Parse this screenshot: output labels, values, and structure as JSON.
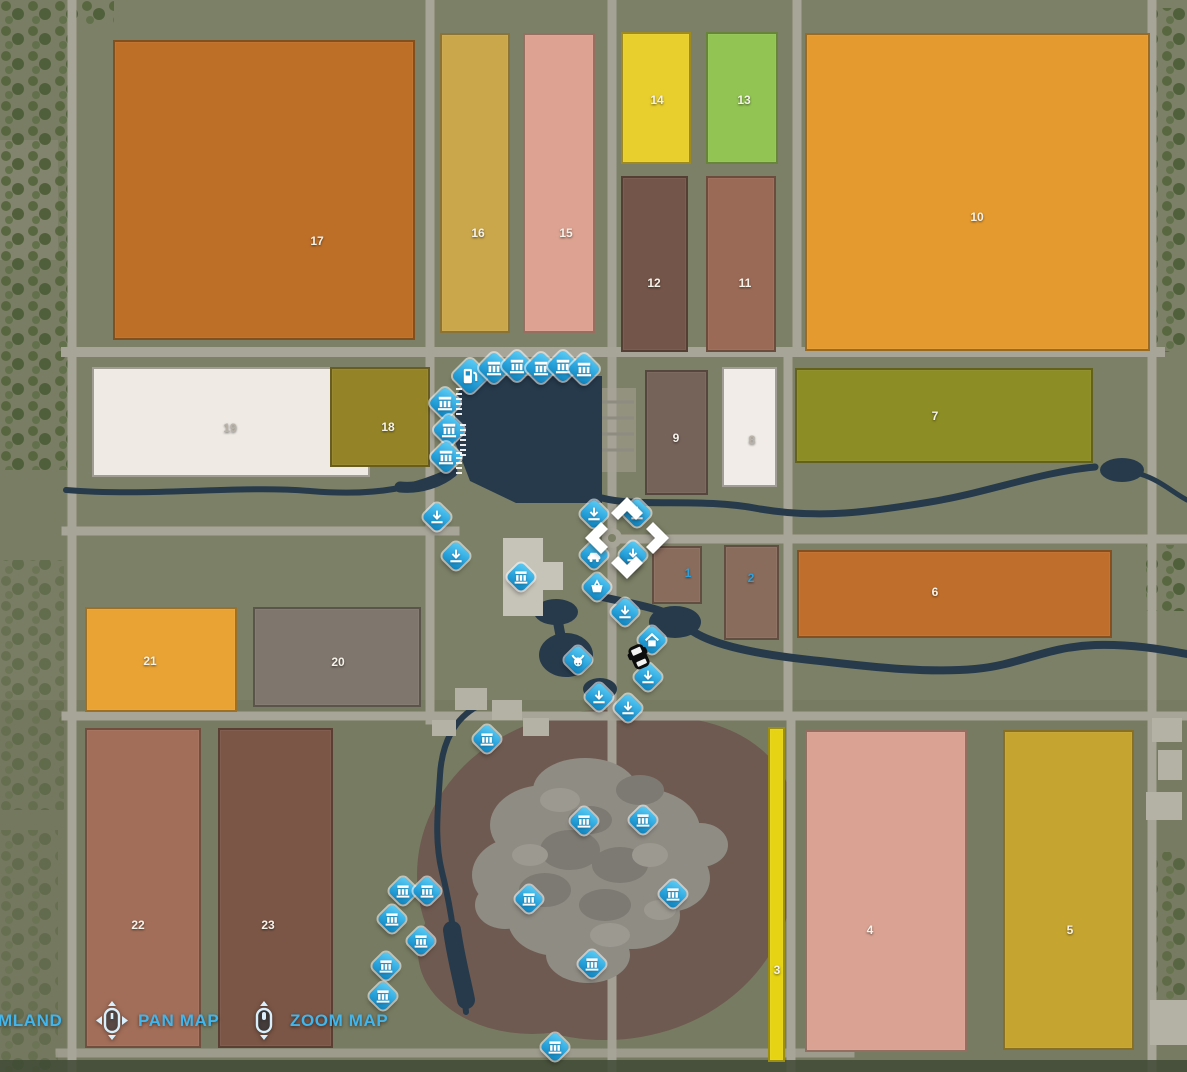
{
  "map": {
    "background_color": "#7c8066",
    "road_color": "#a7a498",
    "water_color": "#263a4c",
    "quarry_color": "#6e5a50",
    "rock_color": "#8f8c84",
    "tree_color": "#57663f",
    "marker_blue": "#2aa4dd",
    "field_number_color": "#f5f2ea",
    "owned_field_number_color": "#2d9fdb",
    "accent_color": "#41b5ec"
  },
  "fields": [
    {
      "number": "17",
      "x": 113,
      "y": 40,
      "w": 302,
      "h": 300,
      "color": "#bd6f28",
      "label_x": 317,
      "label_y": 241
    },
    {
      "number": "16",
      "x": 440,
      "y": 33,
      "w": 70,
      "h": 300,
      "color": "#cba74b",
      "label_x": 478,
      "label_y": 233
    },
    {
      "number": "15",
      "x": 523,
      "y": 33,
      "w": 72,
      "h": 300,
      "color": "#dda291",
      "label_x": 566,
      "label_y": 233
    },
    {
      "number": "14",
      "x": 621,
      "y": 32,
      "w": 70,
      "h": 132,
      "color": "#e9cf2d",
      "label_x": 657,
      "label_y": 100
    },
    {
      "number": "13",
      "x": 706,
      "y": 32,
      "w": 72,
      "h": 132,
      "color": "#92c453",
      "label_x": 744,
      "label_y": 100
    },
    {
      "number": "12",
      "x": 621,
      "y": 176,
      "w": 67,
      "h": 176,
      "color": "#745549",
      "label_x": 654,
      "label_y": 283
    },
    {
      "number": "11",
      "x": 706,
      "y": 176,
      "w": 70,
      "h": 176,
      "color": "#9a6a56",
      "label_x": 745,
      "label_y": 283
    },
    {
      "number": "10",
      "x": 805,
      "y": 33,
      "w": 345,
      "h": 318,
      "color": "#e49a2e",
      "label_x": 977,
      "label_y": 217
    },
    {
      "number": "19",
      "x": 92,
      "y": 367,
      "w": 278,
      "h": 110,
      "color": "#efeae4",
      "label_x": 230,
      "label_y": 428,
      "number_color": "#b9b3a9"
    },
    {
      "number": "18",
      "x": 330,
      "y": 367,
      "w": 100,
      "h": 100,
      "color": "#948427",
      "label_x": 388,
      "label_y": 427
    },
    {
      "number": "9",
      "x": 645,
      "y": 370,
      "w": 63,
      "h": 125,
      "color": "#756259",
      "label_x": 676,
      "label_y": 438
    },
    {
      "number": "8",
      "x": 722,
      "y": 367,
      "w": 55,
      "h": 120,
      "color": "#f1ece7",
      "label_x": 752,
      "label_y": 440,
      "number_color": "#b9b3a9"
    },
    {
      "number": "7",
      "x": 795,
      "y": 368,
      "w": 298,
      "h": 95,
      "color": "#8c8d24",
      "label_x": 935,
      "label_y": 416
    },
    {
      "number": "1",
      "x": 652,
      "y": 546,
      "w": 50,
      "h": 58,
      "color": "#8a6c5c",
      "label_x": 688,
      "label_y": 573,
      "owned": true
    },
    {
      "number": "2",
      "x": 724,
      "y": 545,
      "w": 55,
      "h": 95,
      "color": "#8a6c5c",
      "label_x": 751,
      "label_y": 578,
      "owned": true
    },
    {
      "number": "6",
      "x": 797,
      "y": 550,
      "w": 315,
      "h": 88,
      "color": "#c06e2b",
      "label_x": 935,
      "label_y": 592
    },
    {
      "number": "21",
      "x": 85,
      "y": 607,
      "w": 152,
      "h": 105,
      "color": "#e9a334",
      "label_x": 150,
      "label_y": 661
    },
    {
      "number": "20",
      "x": 253,
      "y": 607,
      "w": 168,
      "h": 100,
      "color": "#7f766d",
      "label_x": 338,
      "label_y": 662
    },
    {
      "number": "22",
      "x": 85,
      "y": 728,
      "w": 116,
      "h": 320,
      "color": "#a26e59",
      "label_x": 138,
      "label_y": 925
    },
    {
      "number": "23",
      "x": 218,
      "y": 728,
      "w": 115,
      "h": 320,
      "color": "#7b5646",
      "label_x": 268,
      "label_y": 925
    },
    {
      "number": "3",
      "x": 768,
      "y": 727,
      "w": 17,
      "h": 335,
      "color": "#e6d313",
      "label_x": 777,
      "label_y": 970
    },
    {
      "number": "4",
      "x": 805,
      "y": 730,
      "w": 162,
      "h": 322,
      "color": "#daa292",
      "label_x": 870,
      "label_y": 930
    },
    {
      "number": "5",
      "x": 1003,
      "y": 730,
      "w": 131,
      "h": 320,
      "color": "#c6a430",
      "label_x": 1070,
      "label_y": 930
    }
  ],
  "markers": [
    {
      "type": "fuel",
      "x": 470,
      "y": 376,
      "s": 27
    },
    {
      "type": "production",
      "x": 494,
      "y": 368,
      "s": 24
    },
    {
      "type": "production",
      "x": 517,
      "y": 366,
      "s": 24
    },
    {
      "type": "production",
      "x": 541,
      "y": 368,
      "s": 24
    },
    {
      "type": "production",
      "x": 563,
      "y": 366,
      "s": 24
    },
    {
      "type": "production",
      "x": 584,
      "y": 369,
      "s": 24
    },
    {
      "type": "production",
      "x": 445,
      "y": 403,
      "s": 24
    },
    {
      "type": "production",
      "x": 449,
      "y": 430,
      "s": 24
    },
    {
      "type": "production",
      "x": 446,
      "y": 457,
      "s": 24
    },
    {
      "type": "download",
      "x": 437,
      "y": 517
    },
    {
      "type": "download",
      "x": 456,
      "y": 556
    },
    {
      "type": "production",
      "x": 521,
      "y": 577
    },
    {
      "type": "basket",
      "x": 597,
      "y": 587
    },
    {
      "type": "download",
      "x": 594,
      "y": 514
    },
    {
      "type": "download",
      "x": 637,
      "y": 513
    },
    {
      "type": "vehicle",
      "x": 594,
      "y": 555
    },
    {
      "type": "download",
      "x": 633,
      "y": 555
    },
    {
      "type": "download",
      "x": 625,
      "y": 612
    },
    {
      "type": "home",
      "x": 652,
      "y": 640
    },
    {
      "type": "cow",
      "x": 578,
      "y": 660
    },
    {
      "type": "download",
      "x": 648,
      "y": 677
    },
    {
      "type": "download",
      "x": 599,
      "y": 697
    },
    {
      "type": "download",
      "x": 628,
      "y": 708
    },
    {
      "type": "production",
      "x": 487,
      "y": 739
    },
    {
      "type": "production",
      "x": 584,
      "y": 821
    },
    {
      "type": "production",
      "x": 643,
      "y": 820
    },
    {
      "type": "production",
      "x": 529,
      "y": 899
    },
    {
      "type": "production",
      "x": 673,
      "y": 894
    },
    {
      "type": "production",
      "x": 592,
      "y": 964
    },
    {
      "type": "production",
      "x": 403,
      "y": 891
    },
    {
      "type": "production",
      "x": 427,
      "y": 891
    },
    {
      "type": "production",
      "x": 392,
      "y": 919
    },
    {
      "type": "production",
      "x": 421,
      "y": 941
    },
    {
      "type": "production",
      "x": 386,
      "y": 966
    },
    {
      "type": "production",
      "x": 383,
      "y": 996
    },
    {
      "type": "production",
      "x": 555,
      "y": 1047
    }
  ],
  "player_marker": {
    "x": 640,
    "y": 659
  },
  "footer": {
    "farmland_label": "MLAND",
    "pan_label": "PAN MAP",
    "zoom_label": "ZOOM MAP"
  }
}
